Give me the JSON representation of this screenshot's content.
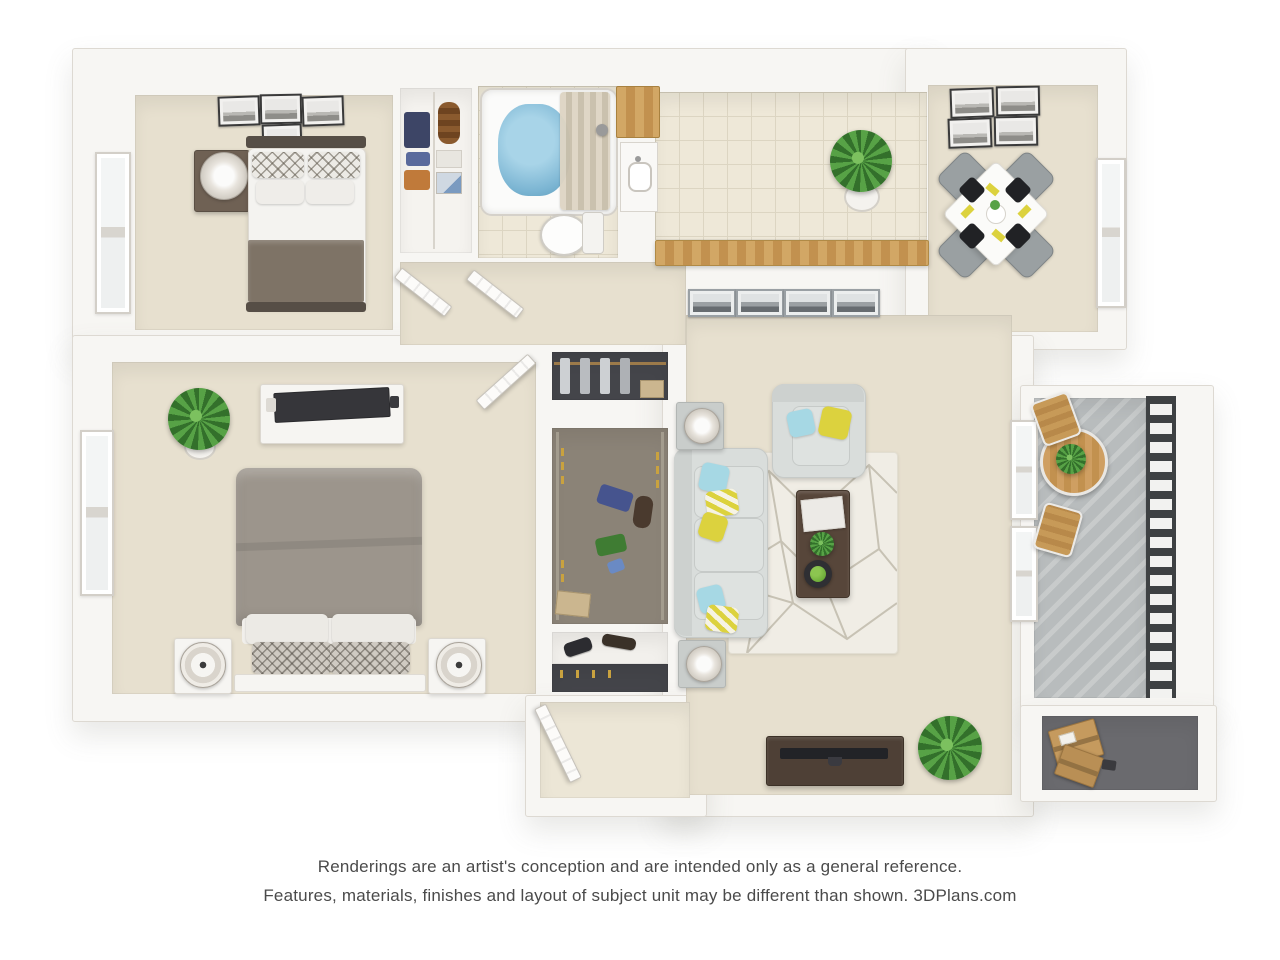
{
  "footer": {
    "line1": "Renderings are an artist's conception and are intended only as a general reference.",
    "line2": "Features, materials, finishes and layout of subject unit may be different than shown. 3DPlans.com"
  },
  "palette": {
    "canvas": "#ffffff",
    "wall": "#f7f6f3",
    "wall-edge": "#ddd9d2",
    "carpet": "#e7e0cf",
    "tile": "#eee8d8",
    "tile-line": "#dcd5c2",
    "wood": "#cda05f",
    "wood-dark": "#57463a",
    "tv-wood": "#4e4036",
    "sofa": "#d9dddb",
    "sofa-dark": "#c6cac8",
    "bed-gray": "#9c958c",
    "bed-brown": "#7e7366",
    "headboard": "#564e46",
    "linen": "#f4f3f0",
    "accent-yellow": "#dcd23e",
    "accent-blue": "#a6d8e4",
    "plant": "#57a246",
    "plant-dark": "#33702b",
    "concrete": "#b8bcbd",
    "railing": "#3e4143",
    "water": "#7ab4d2",
    "rug": "#f0ede5",
    "rug-line": "#c7c2b4",
    "frame-dark": "#3a3a3a",
    "frame-silver": "#9aa0a4",
    "closet-floor": "#8b8377",
    "closet-dark": "#44454a",
    "box-tan": "#c59a5e",
    "chair-gray": "#9aa0a2",
    "text": "#4a4a4a"
  }
}
